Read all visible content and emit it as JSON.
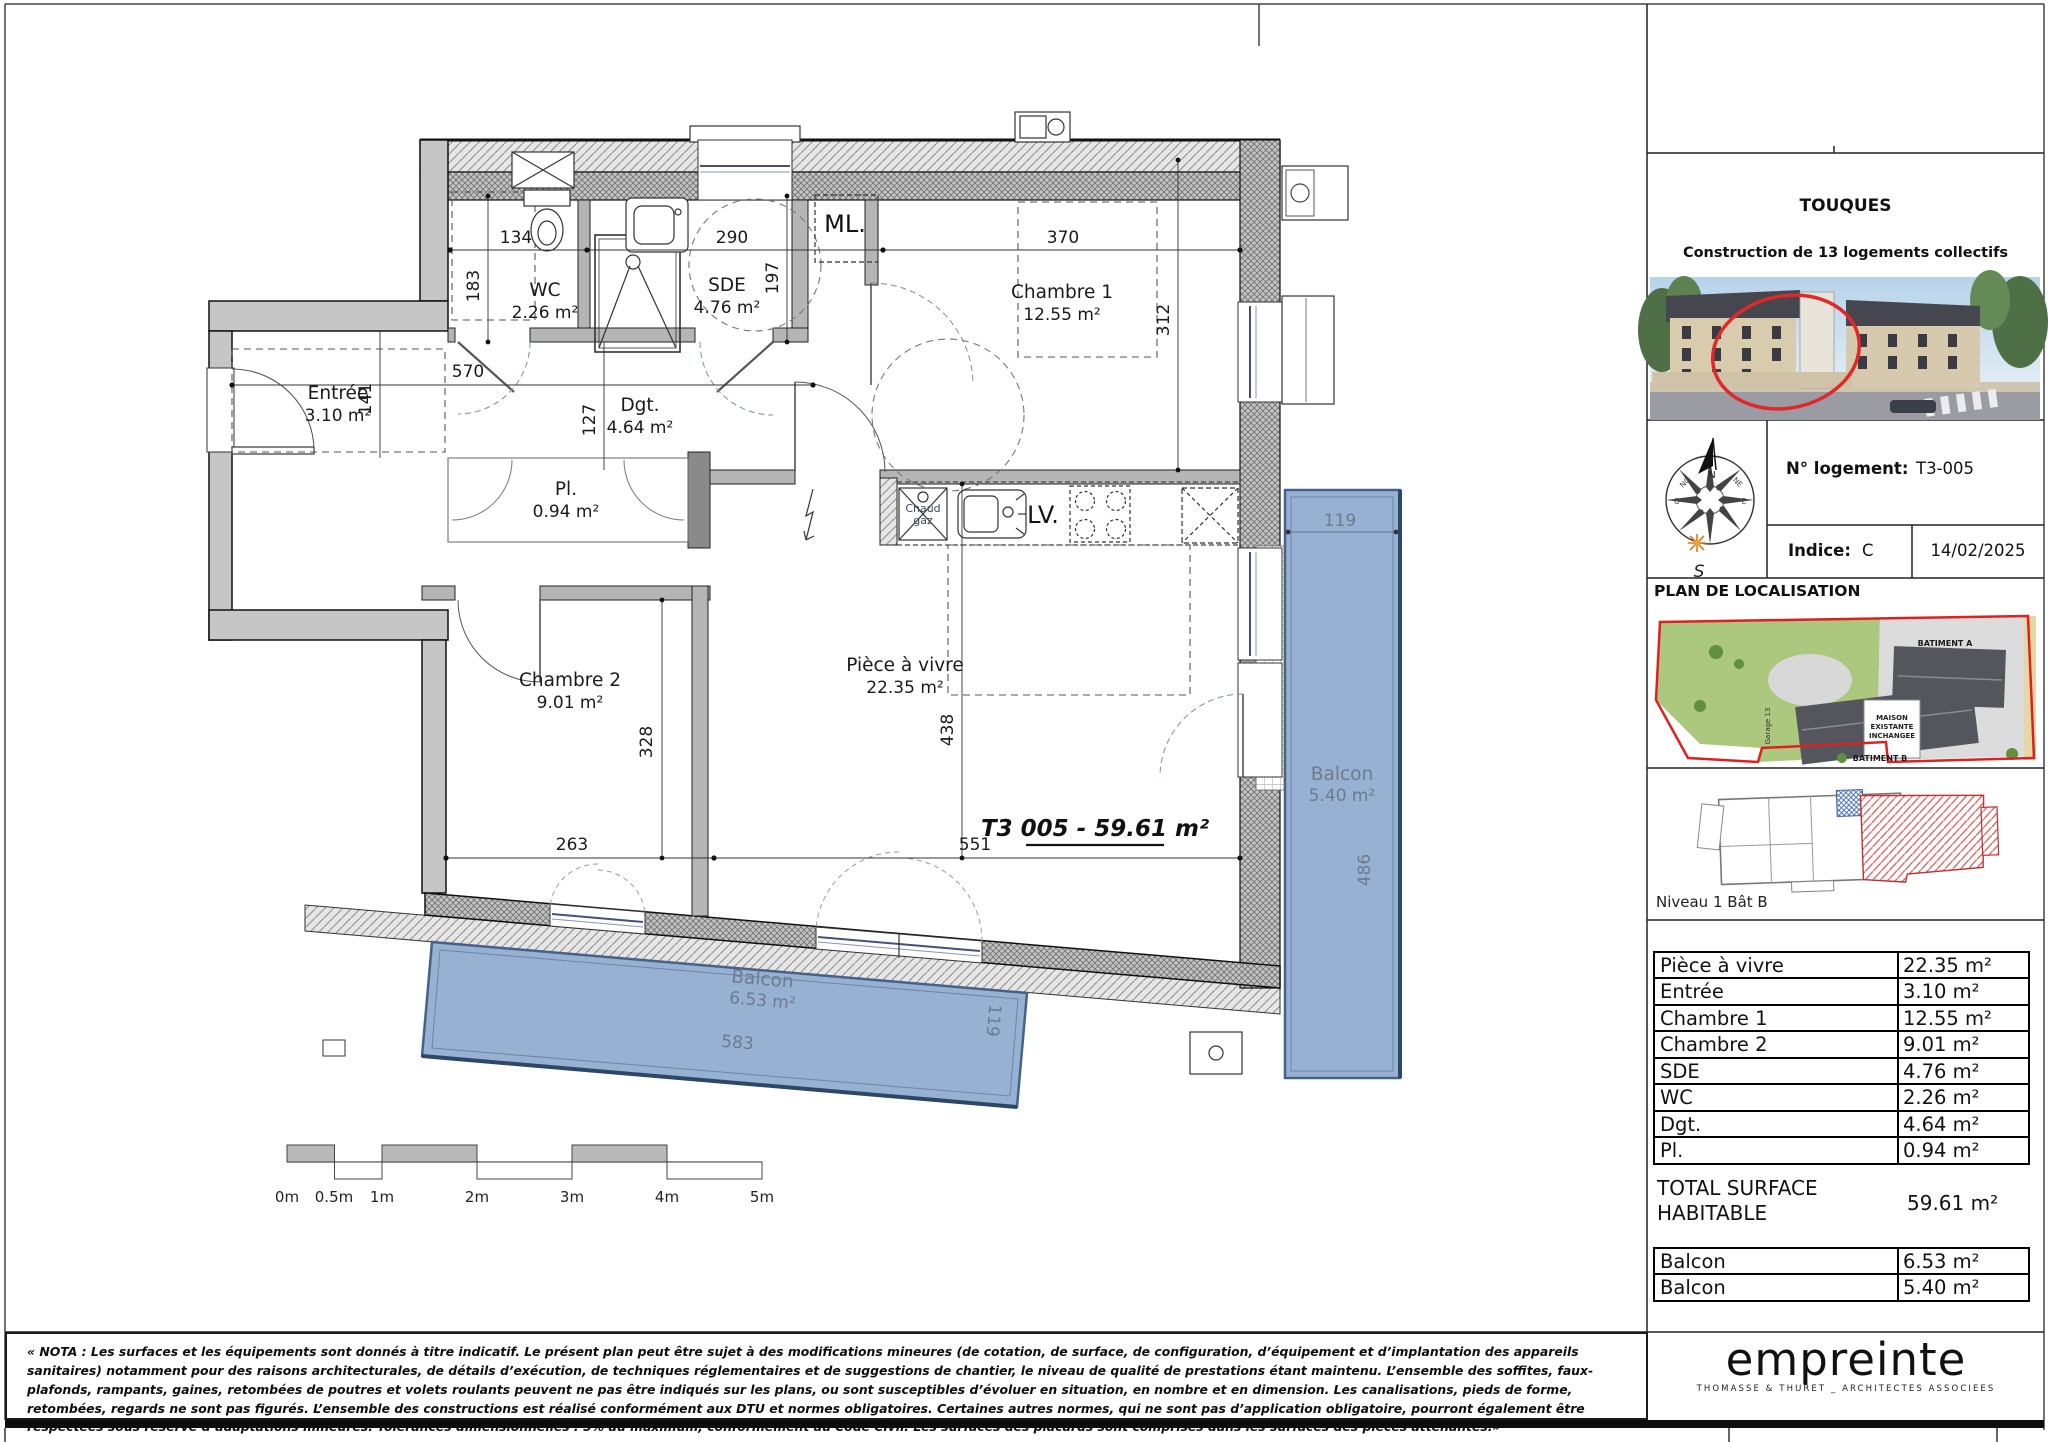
{
  "header": {
    "city": "TOUQUES",
    "project": "Construction de 13 logements collectifs"
  },
  "logement": {
    "label": "N° logement:",
    "value": "T3-005",
    "indice_label": "Indice:",
    "indice_value": "C",
    "date": "14/02/2025"
  },
  "localisation": {
    "title": "PLAN DE LOCALISATION",
    "batiment_a": "BATIMENT A",
    "batiment_b": "BATIMENT B",
    "maison_1": "MAISON",
    "maison_2": "EXISTANTE",
    "maison_3": "INCHANGEE",
    "garage": "Garage 13",
    "niveau_caption": "Niveau 1 Bât B"
  },
  "surface_table": {
    "rows": [
      {
        "label": "Pièce à vivre",
        "value": "22.35 m²"
      },
      {
        "label": "Entrée",
        "value": "3.10 m²"
      },
      {
        "label": "Chambre 1",
        "value": "12.55 m²"
      },
      {
        "label": "Chambre 2",
        "value": "9.01 m²"
      },
      {
        "label": "SDE",
        "value": "4.76 m²"
      },
      {
        "label": "WC",
        "value": "2.26 m²"
      },
      {
        "label": "Dgt.",
        "value": "4.64 m²"
      },
      {
        "label": "Pl.",
        "value": "0.94 m²"
      }
    ],
    "total_label": "TOTAL SURFACE HABITABLE",
    "total_value": "59.61 m²",
    "balcony_rows": [
      {
        "label": "Balcon",
        "value": "6.53 m²"
      },
      {
        "label": "Balcon",
        "value": "5.40 m²"
      }
    ]
  },
  "plan": {
    "unit_label": "T3 005 - 59.61 m²",
    "rooms": [
      {
        "name": "WC",
        "area": "2.26 m²"
      },
      {
        "name": "SDE",
        "area": "4.76 m²"
      },
      {
        "name": "Entrée",
        "area": "3.10 m²"
      },
      {
        "name": "Dgt.",
        "area": "4.64 m²"
      },
      {
        "name": "Pl.",
        "area": "0.94 m²"
      },
      {
        "name": "Chambre 1",
        "area": "12.55 m²"
      },
      {
        "name": "Chambre 2",
        "area": "9.01 m²"
      },
      {
        "name": "Pièce à vivre",
        "area": "22.35 m²"
      }
    ],
    "balconies": [
      {
        "name": "Balcon",
        "area": "6.53 m²",
        "length": "583",
        "width": "119"
      },
      {
        "name": "Balcon",
        "area": "5.40 m²",
        "length": "486",
        "width": "119"
      }
    ],
    "dims": {
      "wc_width": "134",
      "wc_depth": "183",
      "sde_width": "290",
      "sde_depth": "197",
      "ch1_width": "370",
      "ch1_depth": "312",
      "entree_width": "570",
      "entree_depth": "141",
      "dgt_width": "127",
      "ch2_width": "263",
      "ch2_depth": "328",
      "living_width": "551",
      "living_depth": "438"
    },
    "fixtures": {
      "ml": "ML.",
      "lv": "LV.",
      "chaud_1": "Chaud",
      "chaud_2": "gaz"
    }
  },
  "compass": {
    "n": "N",
    "s": "S",
    "no": "NO",
    "ne": "NE",
    "o": "O",
    "e": "E"
  },
  "scalebar": {
    "labels": [
      "0m",
      "0.5m",
      "1m",
      "2m",
      "3m",
      "4m",
      "5m"
    ]
  },
  "nota": "« NOTA : Les surfaces et les équipements sont donnés à titre indicatif. Le présent plan peut être sujet à des modifications mineures (de cotation, de surface, de configuration, d’équipement et d’implantation des appareils sanitaires) notamment pour des raisons architecturales, de détails d’exécution, de techniques réglementaires et de suggestions de chantier, le niveau de qualité de prestations étant maintenu. L’ensemble des soffites, faux-plafonds, rampants, gaines, retombées de poutres et volets roulants peuvent ne pas être indiqués sur les plans, ou sont susceptibles d’évoluer en situation, en nombre et en dimension. Les canalisations, pieds de forme, retombées, regards ne sont pas figurés. L’ensemble des constructions est réalisé conformément aux DTU et normes obligatoires. Certaines autres normes, qui ne sont pas d’application obligatoire, pourront également être respectées sous réserve d’adaptations mineures. Tolérances dimensionnelles : 5% au maximum, conformément au Code Civil. Les surfaces des placards sont comprises dans les surfaces des pièces attenantes.»",
  "logo": {
    "name": "empreinte",
    "tagline": "THOMASSE & THURET _ ARCHITECTES ASSOCIEES"
  }
}
